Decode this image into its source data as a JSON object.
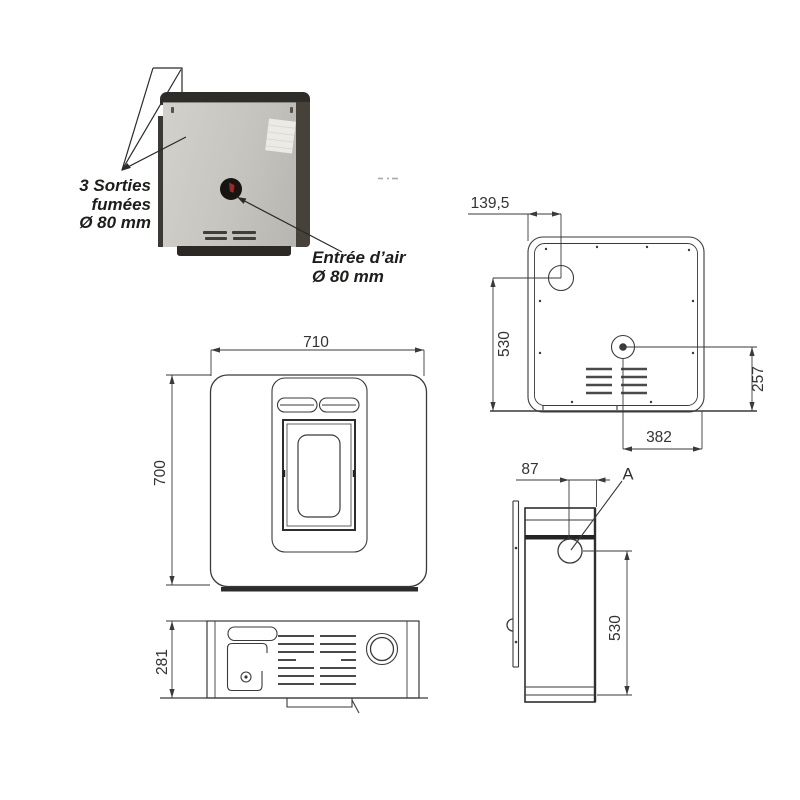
{
  "photo": {
    "annotations": {
      "smoke": {
        "lines": [
          "3 Sorties",
          "fumées",
          "Ø 80 mm"
        ]
      },
      "air": {
        "lines": [
          "Entrée d’air",
          "Ø 80 mm"
        ]
      }
    }
  },
  "views": {
    "rear": {
      "dims": {
        "top": "139,5",
        "left": "530",
        "right": "257",
        "bottom": "382"
      }
    },
    "front": {
      "dims": {
        "width": "710",
        "height": "700"
      }
    },
    "top": {
      "dims": {
        "depth": "281"
      }
    },
    "side": {
      "dims": {
        "offset": "87",
        "height": "530"
      },
      "detail_label": "A"
    }
  },
  "colors": {
    "line": "#3a3a3a",
    "dark_line": "#242424",
    "text": "#1d1d1b",
    "panel_gray": "#c9c7c1",
    "accent_red": "#9b2a23"
  }
}
